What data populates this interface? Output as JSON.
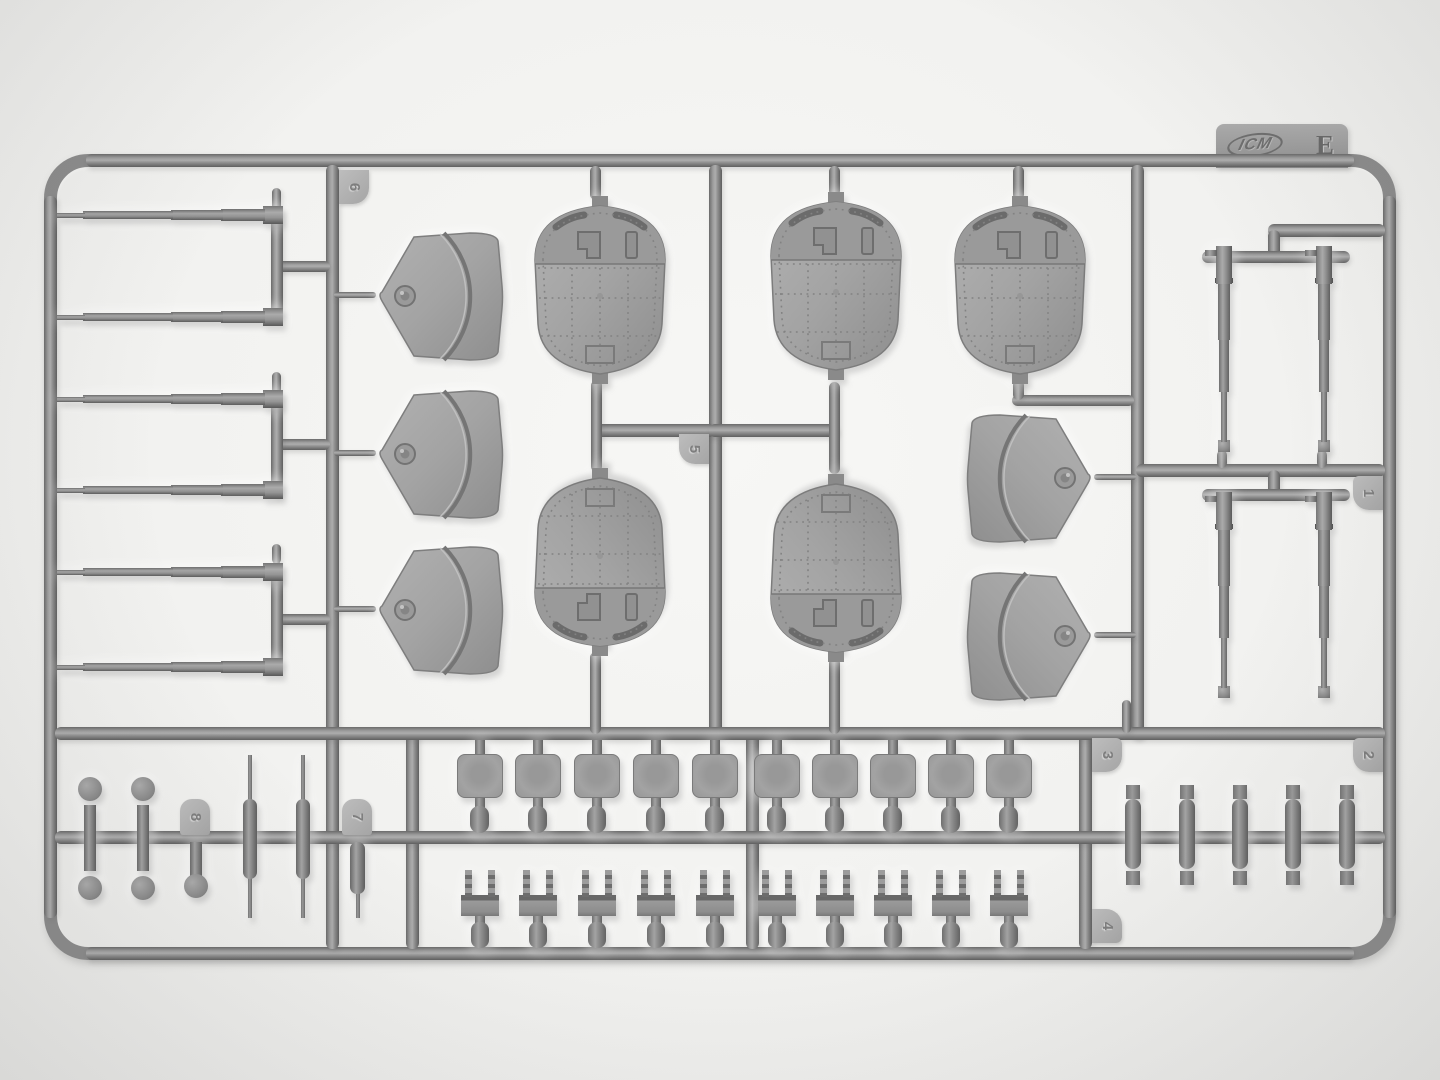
{
  "photo": {
    "subject": "Gray injection-molded plastic model-kit sprue (parts tree) photographed on a white background"
  },
  "sprue": {
    "brand": "ICM",
    "letter": "E",
    "tabs": [
      "1",
      "2",
      "3",
      "4",
      "5",
      "6",
      "7",
      "8"
    ]
  }
}
